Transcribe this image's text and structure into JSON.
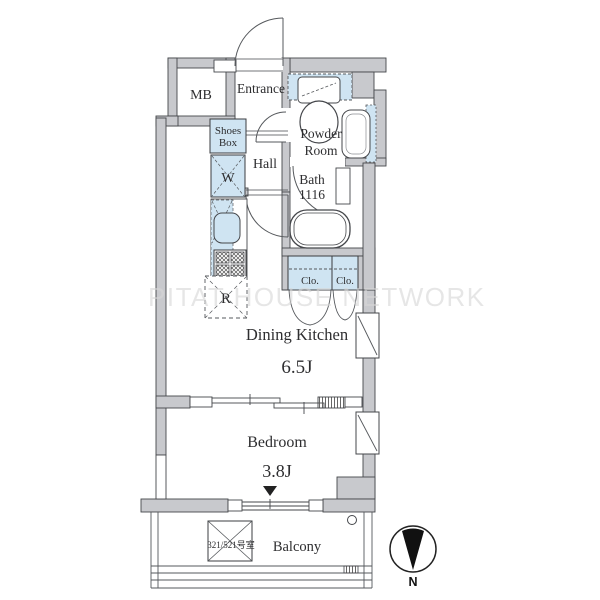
{
  "floorplan": {
    "watermark": "PITAT HOUSE NETWORK",
    "labels": {
      "mb": "MB",
      "entrance": "Entrance",
      "shoes_box_line1": "Shoes",
      "shoes_box_line2": "Box",
      "hall": "Hall",
      "powder_room_line1": "Powder",
      "powder_room_line2": "Room",
      "bath_line1": "Bath",
      "bath_line2": "1116",
      "washer": "W",
      "refrigerator": "R",
      "closet1": "Clo.",
      "closet2": "Clo.",
      "dining_kitchen": "Dining Kitchen",
      "dining_kitchen_size": "6.5J",
      "bedroom": "Bedroom",
      "bedroom_size": "3.8J",
      "balcony": "Balcony",
      "room_number": "321/521号室"
    },
    "compass": {
      "north_label": "N"
    },
    "colors": {
      "wall": "#c8c9cd",
      "fixture_blue": "#cfe4f2",
      "line": "#3f4144",
      "watermark": "#d7d7d7",
      "background": "#ffffff"
    }
  }
}
